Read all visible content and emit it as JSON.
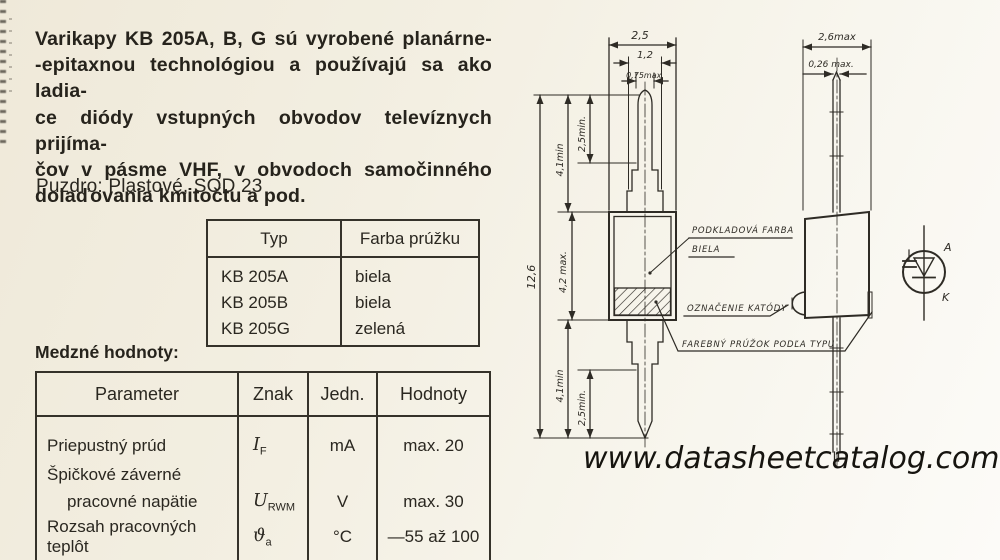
{
  "colors": {
    "paper": "#f3efe2",
    "ink": "#26231c",
    "line": "#2e2b25"
  },
  "intro": {
    "lines": [
      "Varikapy KB 205A, B, G sú vyrobené planárne-",
      "-epitaxnou technológiou a používajú sa ako ladia-",
      "ce diódy vstupných obvodov televíznych prijíma-",
      "čov v pásme VHF, v obvodoch samočinného",
      "dolaďovania kmitočtu a pod."
    ]
  },
  "package_line": "Puzdro: Plastové, SOD 23",
  "type_table": {
    "col1": "Typ",
    "col2": "Farba prúžku",
    "rows": [
      {
        "typ": "KB 205A",
        "farba": "biela"
      },
      {
        "typ": "KB 205B",
        "farba": "biela"
      },
      {
        "typ": "KB 205G",
        "farba": "zelená"
      }
    ]
  },
  "limits": {
    "title": "Medzné hodnoty:",
    "headers": {
      "param": "Parameter",
      "znak": "Znak",
      "jedn": "Jedn.",
      "hodnoty": "Hodnoty"
    },
    "row1": {
      "param": "Priepustný prúd",
      "znak_base": "I",
      "znak_sub": "F",
      "jedn": "mA",
      "hodnoty": "max. 20"
    },
    "row2a": {
      "param": "Špičkové záverné"
    },
    "row2b": {
      "param": "pracovné napätie",
      "znak_base": "U",
      "znak_sub": "RWM",
      "jedn": "V",
      "hodnoty": "max. 30"
    },
    "row3": {
      "param": "Rozsah pracovných teplôt",
      "znak_base": "ϑ",
      "znak_sub": "a",
      "jedn": "°C",
      "hodnoty": "—55 až 100"
    }
  },
  "drawing": {
    "front": {
      "dim_body_width": "2,5",
      "dim_lead_wide": "1,2",
      "dim_lead": "0,75max.",
      "dim_total": "12,6",
      "dim_lead_top": "4,1min",
      "dim_tip_top": "2,5min.",
      "dim_body_height": "4,2 max.",
      "dim_lead_bottom": "4,1min",
      "dim_tip_bottom": "2,5min.",
      "label_base_color_line1": "PODKLADOVÁ FARBA",
      "label_base_color_line2": "BIELA",
      "label_cathode": "OZNAČENIE KATÓDY",
      "label_stripe": "FAREBNÝ PRÚŽOK PODĽA TYPU"
    },
    "side": {
      "dim_width": "2,6max",
      "dim_lead": "0,26 max."
    },
    "symbol": {
      "anode": "A",
      "cathode": "K"
    }
  },
  "footer": {
    "url": "www.datasheetcatalog.com"
  }
}
